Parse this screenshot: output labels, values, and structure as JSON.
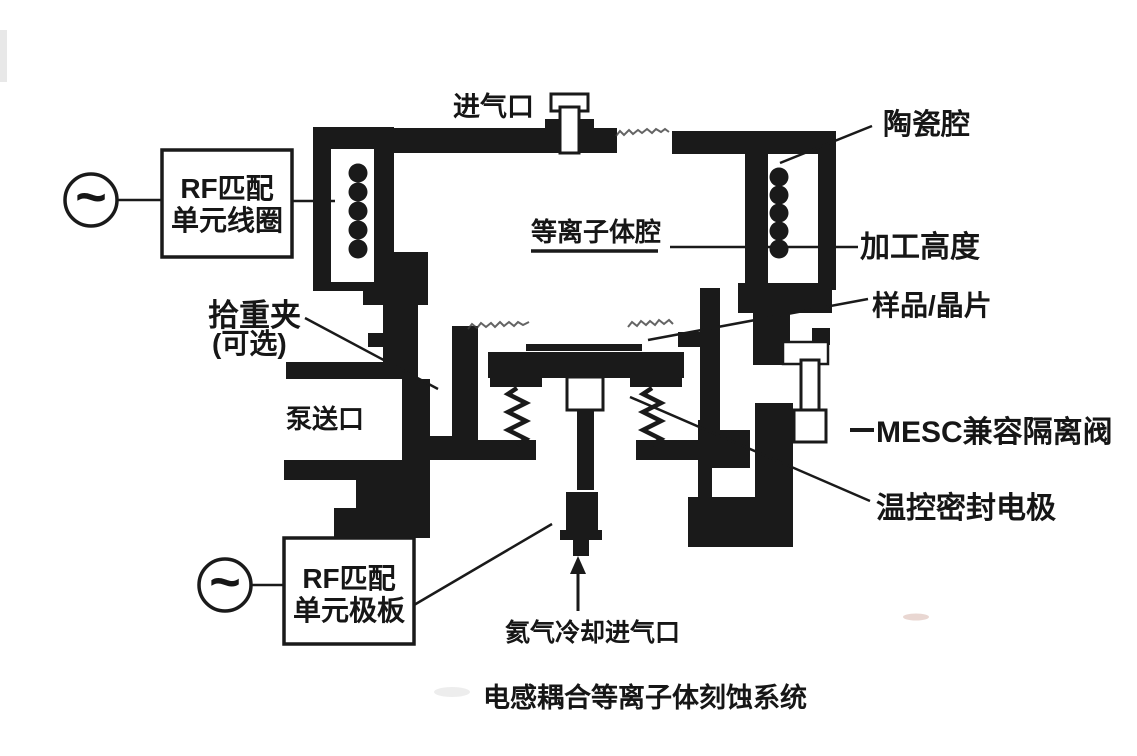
{
  "figure": {
    "title": "电感耦合等离子体刻蚀系统",
    "ac_source_symbol": "~",
    "rf_coil_box": {
      "line1": "RF匹配",
      "line2": "单元线圈"
    },
    "rf_plate_box": {
      "line1": "RF匹配",
      "line2": "单元极板"
    },
    "callouts": {
      "gas_inlet": "进气口",
      "ceramic_chamber": "陶瓷腔",
      "plasma_chamber": "等离子体腔",
      "process_height": "加工高度",
      "sample_wafer": "样品/晶片",
      "clamp": "拾重夹",
      "clamp_optional": "(可选)",
      "pump_port": "泵送口",
      "mesc_isolation_valve": "MESC兼容隔离阀",
      "temp_sealed_electrode": "温控密封电极",
      "helium_cooling_inlet": "氦气冷却进气口"
    },
    "colors": {
      "ink": "#1a1a1a",
      "paper": "#ffffff"
    }
  }
}
